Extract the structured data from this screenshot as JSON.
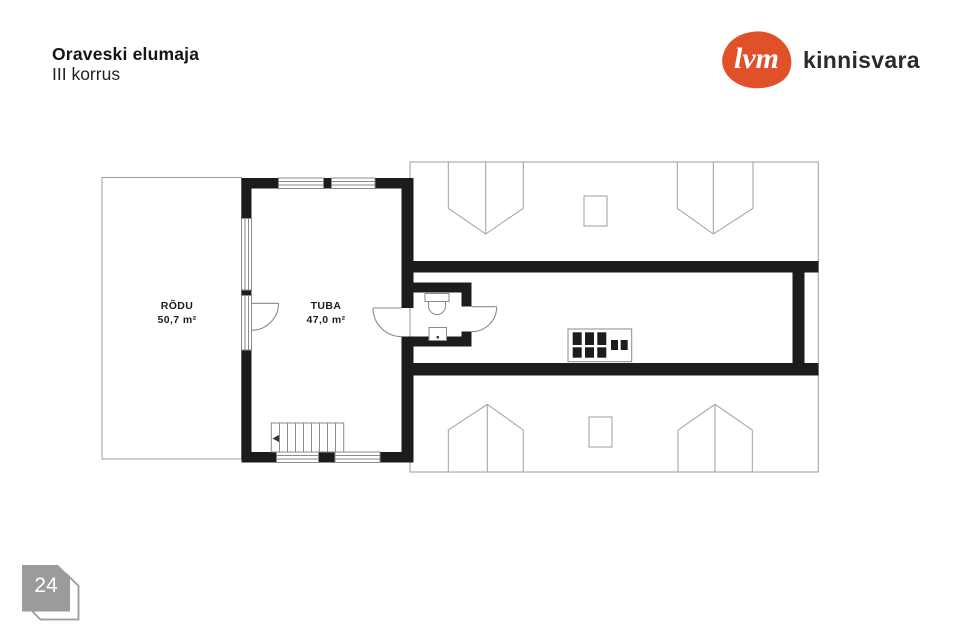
{
  "page": {
    "title": "Oraveski elumaja",
    "subtitle": "III korrus",
    "page_number": "24"
  },
  "logo": {
    "mark_text": "lvm",
    "brand_text": "kinnisvara",
    "accent_color": "#e0512a",
    "brand_text_color": "#2b2b2b"
  },
  "plan": {
    "rooms": [
      {
        "name": "RÕDU",
        "area": "50,7 m²"
      },
      {
        "name": "TUBA",
        "area": "47,0 m²"
      }
    ]
  },
  "colors": {
    "wall": "#1c1c1c",
    "thin_line": "#9e9e9e",
    "badge_gray": "#9b9b9b",
    "background": "#ffffff"
  }
}
